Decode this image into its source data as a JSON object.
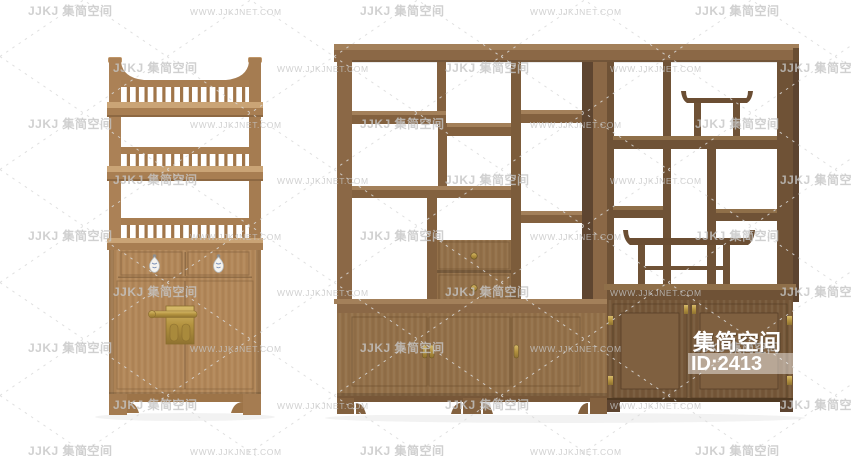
{
  "page": {
    "width": 851,
    "height": 456,
    "background": "#ffffff"
  },
  "watermark": {
    "logo_text": "JJKJ 集简空间",
    "url_text": "WWW.JJKJNET.COM",
    "text_color": "#c5c5c5",
    "lattice_color": "#dadada"
  },
  "overlay": {
    "brand": "集简空间",
    "id_value": "ID:2413",
    "text_color": "#ffffff",
    "highlight_color": "rgba(255,255,255,0.45)"
  },
  "palette": {
    "left_cabinet_wood": "#b28759",
    "left_cabinet_wood_light": "#caa476",
    "left_cabinet_wood_dark": "#97704a",
    "shelf_unit_wood": "#8b6846",
    "shelf_unit_wood_light": "#a3805a",
    "shelf_unit_wood_dark": "#775738",
    "right_section_wood": "#6f5236",
    "right_section_panel": "#7f6040",
    "compartment_depth": "#5e4530",
    "brass_hardware": "#b3923f",
    "porcelain_pull": "#f5f3ee"
  }
}
